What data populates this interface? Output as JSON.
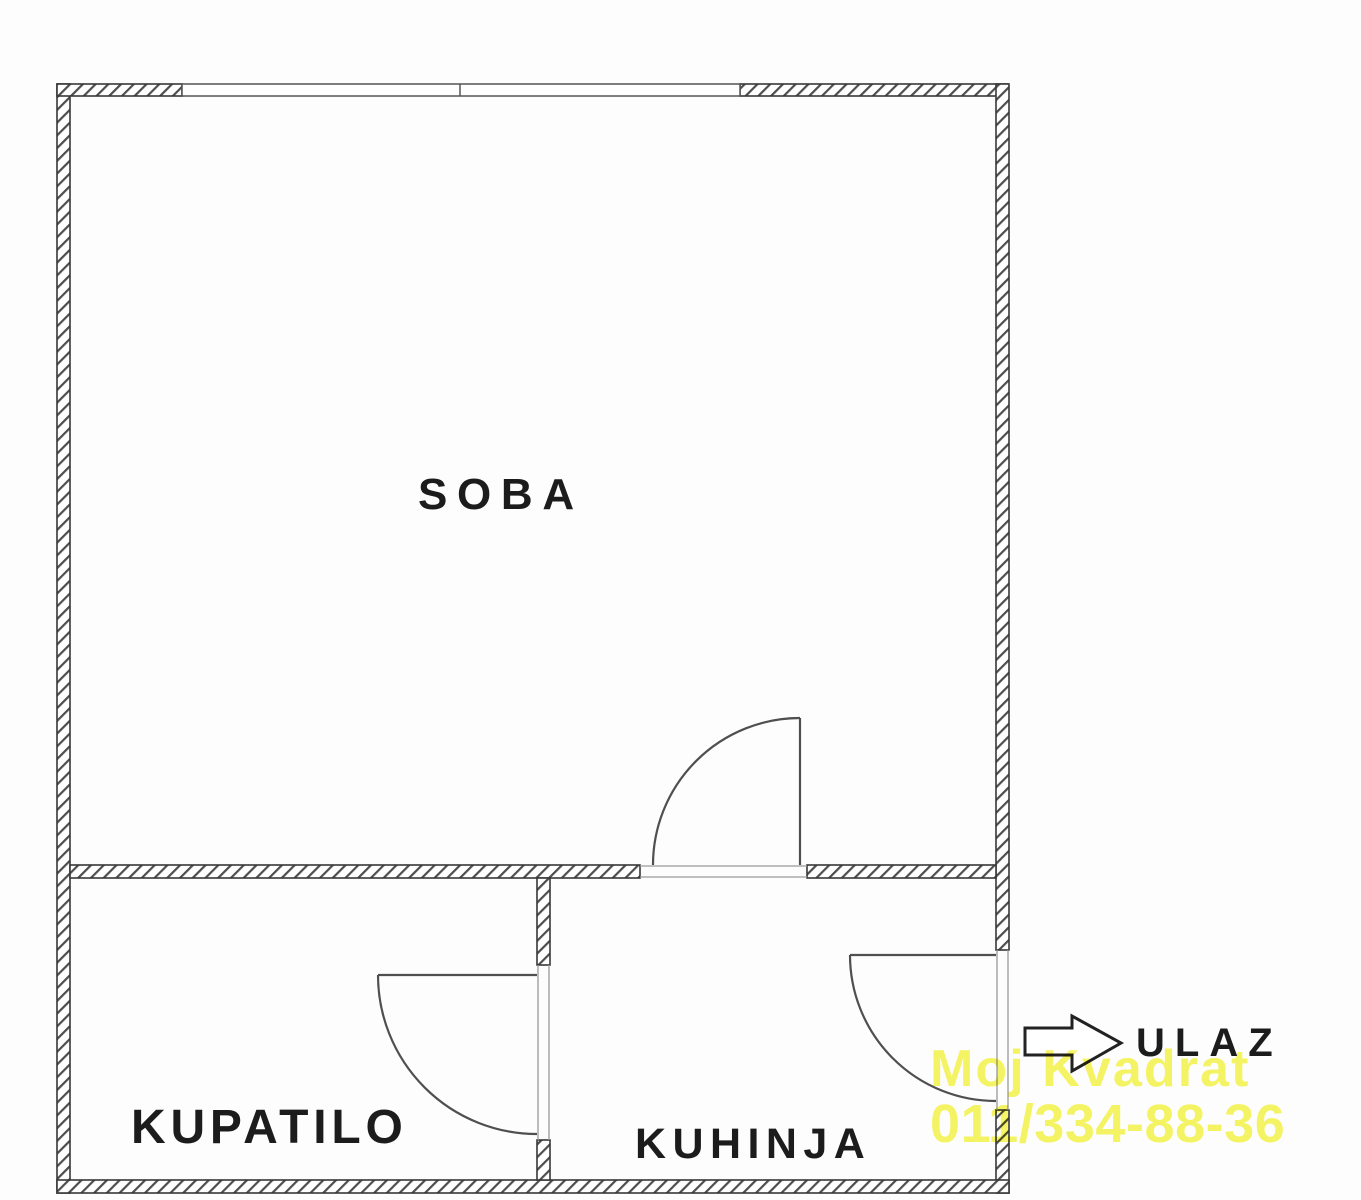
{
  "diagram_type": "apartment-floor-plan",
  "rooms": [
    {
      "id": "soba",
      "label": "SOBA"
    },
    {
      "id": "kupatilo",
      "label": "KUPATILO"
    },
    {
      "id": "kuhinja",
      "label": "KUHINJA"
    }
  ],
  "entrance": {
    "label": "ULAZ",
    "icon": "entrance-arrow-icon"
  },
  "watermark": {
    "line1": "Moj Kvadrat",
    "line2": "011/334-88-36",
    "color": "#f5f558"
  },
  "colors": {
    "wall_line": "#383838",
    "hatch": "#4d4d4d",
    "background": "#fdfdfd"
  }
}
